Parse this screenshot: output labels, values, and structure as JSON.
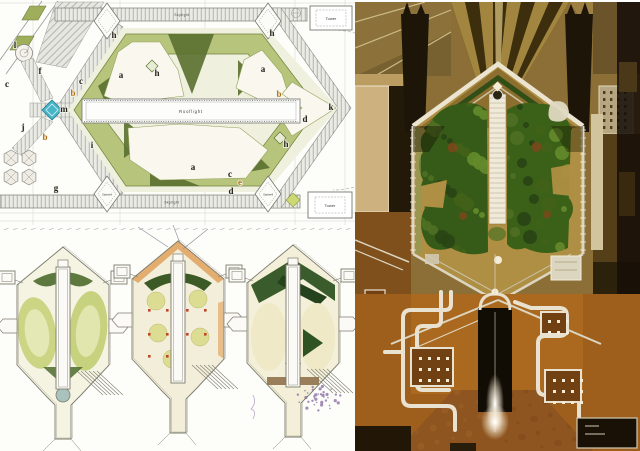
{
  "plan": {
    "rooflight_label": "Rooflight",
    "tower_label_top": "Tower",
    "tower_label_bottom": "Tower",
    "stairwell_label_left": "Stairwell",
    "stairwell_label_right": "Stairwell",
    "skylight_label_top": "Skylight",
    "skylight_label_bottom": "Skylight",
    "key_letters": [
      {
        "char": "l",
        "x": 15,
        "y": 48,
        "color": "#222218"
      },
      {
        "char": "f",
        "x": 40,
        "y": 74,
        "color": "#222218"
      },
      {
        "char": "c",
        "x": 7,
        "y": 87,
        "color": "#222218"
      },
      {
        "char": "c",
        "x": 81,
        "y": 84,
        "color": "#222218"
      },
      {
        "char": "b",
        "x": 73,
        "y": 96,
        "color": "#b07010"
      },
      {
        "char": "m",
        "x": 64,
        "y": 112,
        "color": "#222218"
      },
      {
        "char": "j",
        "x": 23,
        "y": 130,
        "color": "#222218"
      },
      {
        "char": "b",
        "x": 45,
        "y": 140,
        "color": "#b07010"
      },
      {
        "char": "i",
        "x": 92,
        "y": 148,
        "color": "#222218"
      },
      {
        "char": "g",
        "x": 56,
        "y": 191,
        "color": "#222218"
      },
      {
        "char": "h",
        "x": 114,
        "y": 38,
        "color": "#222218"
      },
      {
        "char": "a",
        "x": 121,
        "y": 78,
        "color": "#222218"
      },
      {
        "char": "h",
        "x": 157,
        "y": 76,
        "color": "#222218"
      },
      {
        "char": "h",
        "x": 272,
        "y": 36,
        "color": "#222218"
      },
      {
        "char": "a",
        "x": 263,
        "y": 72,
        "color": "#222218"
      },
      {
        "char": "b",
        "x": 279,
        "y": 97,
        "color": "#b07010"
      },
      {
        "char": "k",
        "x": 331,
        "y": 110,
        "color": "#222218"
      },
      {
        "char": "d",
        "x": 305,
        "y": 122,
        "color": "#222218"
      },
      {
        "char": "h",
        "x": 286,
        "y": 147,
        "color": "#222218"
      },
      {
        "char": "a",
        "x": 193,
        "y": 170,
        "color": "#222218"
      },
      {
        "char": "c",
        "x": 230,
        "y": 177,
        "color": "#222218"
      },
      {
        "char": "e",
        "x": 240,
        "y": 185,
        "color": "#b07010"
      },
      {
        "char": "d",
        "x": 231,
        "y": 194,
        "color": "#222218"
      }
    ],
    "colors": {
      "planting_ring": "#b7c47c",
      "planting_dark": "#5a7030",
      "lawn": "#f9f7ee",
      "water": "#49b6c8",
      "paving_hatch": "#ebebe6"
    }
  },
  "sketches": {
    "colors": {
      "pencil": "#7d7c6e",
      "wash_green": "#cbd584",
      "wash_dark_green": "#3c5a26",
      "wash_orange": "#df9c55",
      "wash_red": "#bf4527",
      "wash_purple": "#8f72a5"
    }
  },
  "photo": {
    "colors": {
      "ground_brown": "#8a703c",
      "shed_dark": "#3c2f12",
      "shed_light": "#a58c4b",
      "garden_paving": "#ab8f4a",
      "planting_left": "#3a5a1e",
      "planting_right": "#3f611f",
      "roof_orange": "#9a6124",
      "duct_white": "#e5dfd0",
      "glazing_dark": "#140f08"
    }
  }
}
